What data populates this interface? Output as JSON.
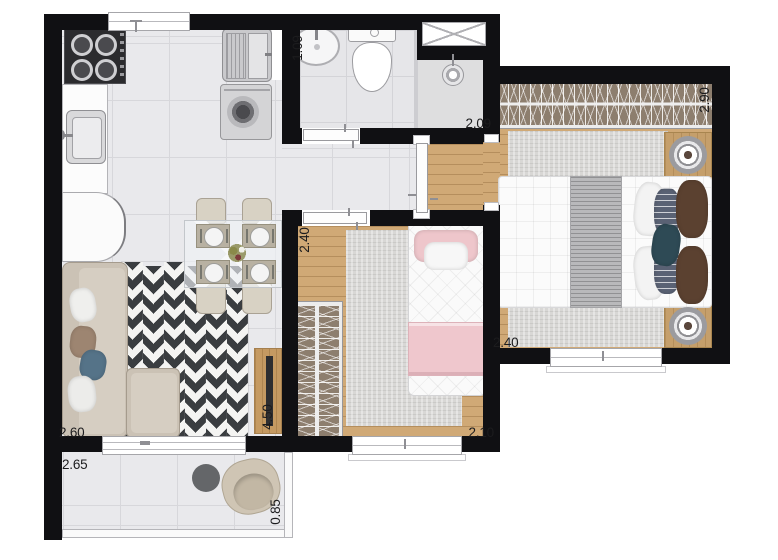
{
  "dimensions": {
    "bathroom_width": "1.09",
    "bathroom_depth": "2.09",
    "master_closet_width": "2.90",
    "master_depth": "2.40",
    "bedroom2_width": "2.40",
    "bedroom2_depth": "2.10",
    "living_depth": "4.50",
    "living_width": "2.60",
    "balcony_length": "2.65",
    "balcony_depth": "0.85"
  },
  "colors": {
    "wall": "#101013",
    "wood_floor": "#d0a976",
    "tile_floor": "#e9e9ec",
    "chevron_dark": "#3a3d40",
    "sofa_beige": "#cbc2b5",
    "accent_pink": "#efc7cd",
    "closet_brown": "#8d7e6e",
    "rug_gray": "#d8d7d5"
  }
}
